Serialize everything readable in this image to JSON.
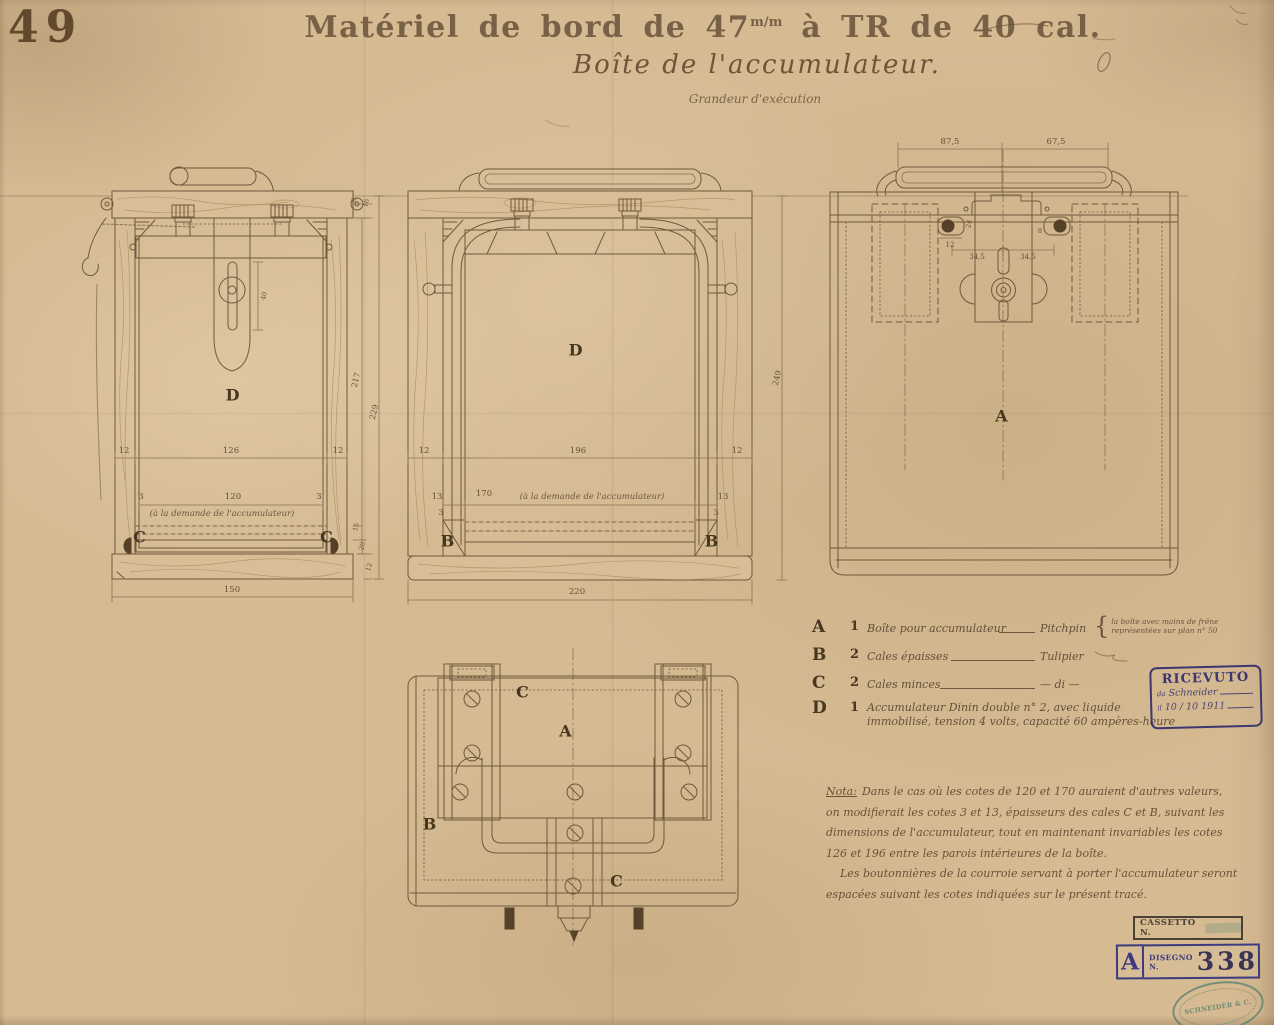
{
  "colors": {
    "paper": "#d5ba92",
    "ink": "#6f593c",
    "stencil": "#47371f",
    "stamp_purple": "#3e3a7e",
    "stamp_teal": "#5e8472"
  },
  "sheet": {
    "number": "49"
  },
  "title": {
    "line1_pre": "Matériel de bord de 47",
    "line1_sup": "m/m",
    "line1_post": " à TR de 40 cal.",
    "line2": "Boîte de l'accumulateur.",
    "line3": "Grandeur d'exécution"
  },
  "legend": {
    "rows": [
      {
        "letter": "A",
        "qty": "1",
        "name": "Boîte pour accumulateur",
        "material": "Pitchpin",
        "brace": "{",
        "note1": "la boîte avec mains de frêne",
        "note2": "représentées sur plan n° 50"
      },
      {
        "letter": "B",
        "qty": "2",
        "name": "Cales épaisses",
        "material": "Tulipier"
      },
      {
        "letter": "C",
        "qty": "2",
        "name": "Cales minces",
        "material": "— di —"
      },
      {
        "letter": "D",
        "qty": "1",
        "name": "Accumulateur Dinin double n° 2, avec liquide",
        "name2": "immobilisé, tension 4 volts, capacité 60 ampères-heure"
      }
    ]
  },
  "nota": {
    "label": "Nota:",
    "lines": [
      "Dans le cas où les cotes de 120 et 170 auraient d'autres valeurs,",
      "on modifierait les cotes 3 et 13, épaisseurs des cales C et B, suivant les",
      "dimensions de l'accumulateur, tout en maintenant invariables les cotes",
      "126 et 196 entre les parois intérieures de la boîte.",
      "Les boutonnières de la courroie servant à porter l'accumulateur seront",
      "espacées suivant les cotes indiquées sur le présent tracé."
    ]
  },
  "stamps": {
    "ricevuto": {
      "title": "RICEVUTO",
      "prefix1": "da",
      "line1": "Schneider",
      "prefix2": "il",
      "line2": "10 / 10 1911"
    },
    "cassetto": {
      "label": "CASSETTO N."
    },
    "disegno": {
      "letter": "A",
      "label": "DISEGNO N.",
      "number": "338"
    },
    "oval": {
      "company": "SCHNEIDER & C."
    }
  },
  "annotations": [
    {
      "t": "12",
      "x": 124,
      "y": 451,
      "n": "dim-side-wall"
    },
    {
      "t": "126",
      "x": 231,
      "y": 451,
      "n": "dim-interior-depth"
    },
    {
      "t": "12",
      "x": 338,
      "y": 451,
      "n": "dim-side-wall"
    },
    {
      "t": "3",
      "x": 141,
      "y": 497,
      "n": "dim-cale-thin"
    },
    {
      "t": "120",
      "x": 233,
      "y": 497,
      "n": "dim-accumulator-depth"
    },
    {
      "t": "3",
      "x": 319,
      "y": 497,
      "n": "dim-cale-thin"
    },
    {
      "t": "(à la demande de l'accumulateur)",
      "x": 222,
      "y": 514,
      "c": "cur",
      "n": "dim-note"
    },
    {
      "t": "C",
      "x": 140,
      "y": 537,
      "c": "L",
      "n": "part-letter-c"
    },
    {
      "t": "C",
      "x": 327,
      "y": 537,
      "c": "L",
      "n": "part-letter-c"
    },
    {
      "t": "150",
      "x": 232,
      "y": 590,
      "n": "dim-overall-depth"
    },
    {
      "t": "40",
      "x": 264,
      "y": 296,
      "r": -80,
      "c": "dv2",
      "n": "dim-slot"
    },
    {
      "t": "8",
      "x": 354,
      "y": 200,
      "r": -76,
      "c": "dv2",
      "n": "dim-small"
    },
    {
      "t": "16",
      "x": 366,
      "y": 203,
      "r": -76,
      "c": "dv2",
      "n": "dim-small"
    },
    {
      "t": "217",
      "x": 356,
      "y": 380,
      "r": -76,
      "c": "dv",
      "n": "dim-height"
    },
    {
      "t": "229",
      "x": 374,
      "y": 412,
      "r": -76,
      "c": "dv",
      "n": "dim-height"
    },
    {
      "t": "15",
      "x": 356,
      "y": 527,
      "r": -76,
      "c": "dv2",
      "n": "dim-small"
    },
    {
      "t": "20",
      "x": 362,
      "y": 546,
      "r": -76,
      "c": "dv2",
      "n": "dim-small"
    },
    {
      "t": "12",
      "x": 369,
      "y": 567,
      "r": -76,
      "c": "dv2",
      "n": "dim-small"
    },
    {
      "t": "D",
      "x": 233,
      "y": 395,
      "c": "L",
      "n": "part-letter-d"
    },
    {
      "t": "12",
      "x": 424,
      "y": 451,
      "n": "dim-side-wall"
    },
    {
      "t": "196",
      "x": 578,
      "y": 451,
      "n": "dim-interior-width"
    },
    {
      "t": "12",
      "x": 737,
      "y": 451,
      "n": "dim-side-wall"
    },
    {
      "t": "13",
      "x": 437,
      "y": 497,
      "n": "dim-cale-thick"
    },
    {
      "t": "170",
      "x": 484,
      "y": 494,
      "n": "dim-accumulator-width"
    },
    {
      "t": "(à la demande de l'accumulateur)",
      "x": 592,
      "y": 497,
      "c": "cur",
      "n": "dim-note"
    },
    {
      "t": "13",
      "x": 723,
      "y": 497,
      "n": "dim-cale-thick"
    },
    {
      "t": "3",
      "x": 441,
      "y": 513,
      "n": "dim-cale-thin"
    },
    {
      "t": "3",
      "x": 716,
      "y": 513,
      "n": "dim-cale-thin"
    },
    {
      "t": "B",
      "x": 448,
      "y": 541,
      "c": "L",
      "n": "part-letter-b"
    },
    {
      "t": "B",
      "x": 712,
      "y": 541,
      "c": "L",
      "n": "part-letter-b"
    },
    {
      "t": "220",
      "x": 577,
      "y": 592,
      "n": "dim-overall-width"
    },
    {
      "t": "249",
      "x": 777,
      "y": 378,
      "r": -78,
      "c": "dv",
      "n": "dim-overall-height"
    },
    {
      "t": "D",
      "x": 576,
      "y": 350,
      "c": "L",
      "n": "part-letter-d"
    },
    {
      "t": "87,5",
      "x": 950,
      "y": 142,
      "n": "dim-top"
    },
    {
      "t": "67,5",
      "x": 1056,
      "y": 142,
      "n": "dim-top"
    },
    {
      "t": "24",
      "x": 969,
      "y": 224,
      "r": -76,
      "c": "dv2",
      "n": "dim-small"
    },
    {
      "t": "8",
      "x": 1040,
      "y": 231,
      "c": "dv2",
      "n": "dim-small"
    },
    {
      "t": "12",
      "x": 950,
      "y": 245,
      "c": "d2",
      "n": "dim-small"
    },
    {
      "t": "34,5",
      "x": 977,
      "y": 257,
      "c": "d2",
      "n": "dim-screw-spacing"
    },
    {
      "t": "34,5",
      "x": 1028,
      "y": 257,
      "c": "d2",
      "n": "dim-screw-spacing"
    },
    {
      "t": "A",
      "x": 1002,
      "y": 416,
      "c": "L",
      "n": "part-letter-a"
    },
    {
      "t": "C",
      "x": 523,
      "y": 692,
      "c": "L",
      "n": "part-letter-c"
    },
    {
      "t": "A",
      "x": 566,
      "y": 731,
      "c": "L",
      "n": "part-letter-a"
    },
    {
      "t": "B",
      "x": 430,
      "y": 824,
      "c": "L",
      "n": "part-letter-b"
    },
    {
      "t": "C",
      "x": 617,
      "y": 881,
      "c": "L",
      "n": "part-letter-c"
    }
  ]
}
